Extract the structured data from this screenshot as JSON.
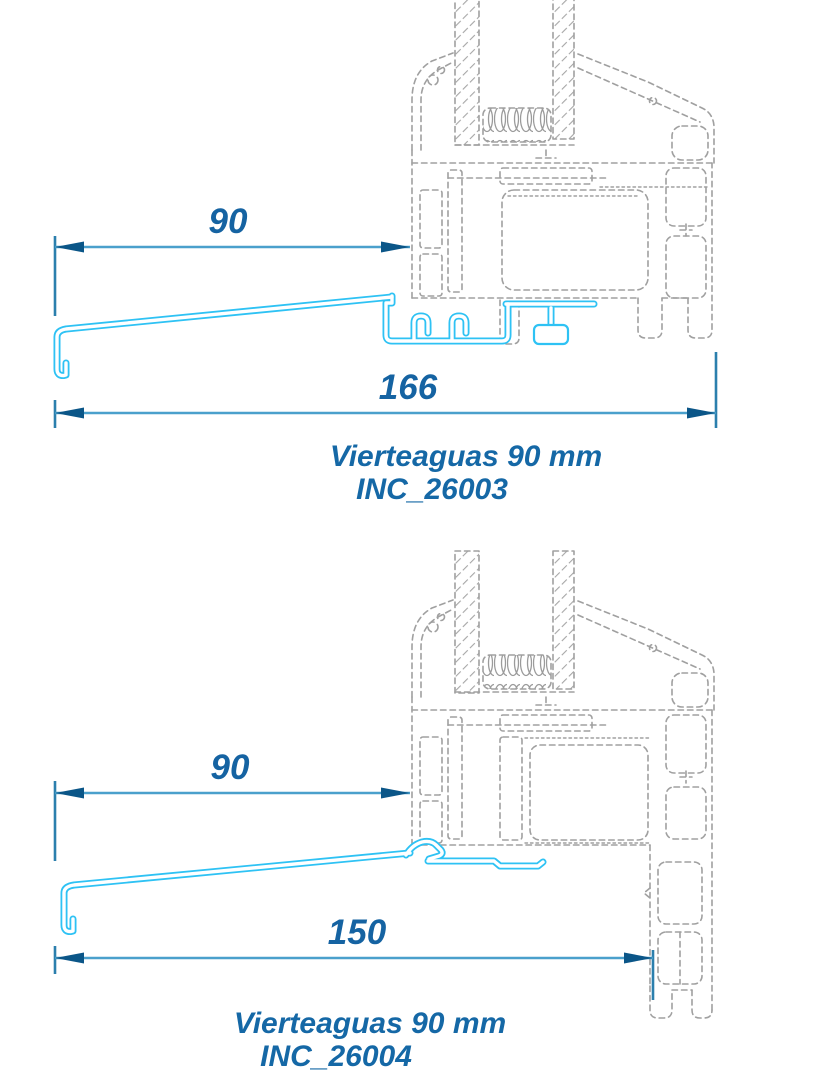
{
  "colors": {
    "background": "#ffffff",
    "profile_cyan": "#2ec2f4",
    "frame_dash_gray": "#a0a0a0",
    "dimension_line": "#4aa0cc",
    "dimension_arrow": "#0b5688",
    "extension_line": "#2b7fad",
    "dimension_text": "#1563a2",
    "label_text": "#1568a6"
  },
  "diagrams": [
    {
      "title": "Vierteaguas 90 mm",
      "code": "INC_26003",
      "dim_sill_projection": "90",
      "dim_total_width": "166"
    },
    {
      "title": "Vierteaguas 90 mm",
      "code": "INC_26004",
      "dim_sill_projection": "90",
      "dim_total_width": "150"
    }
  ]
}
